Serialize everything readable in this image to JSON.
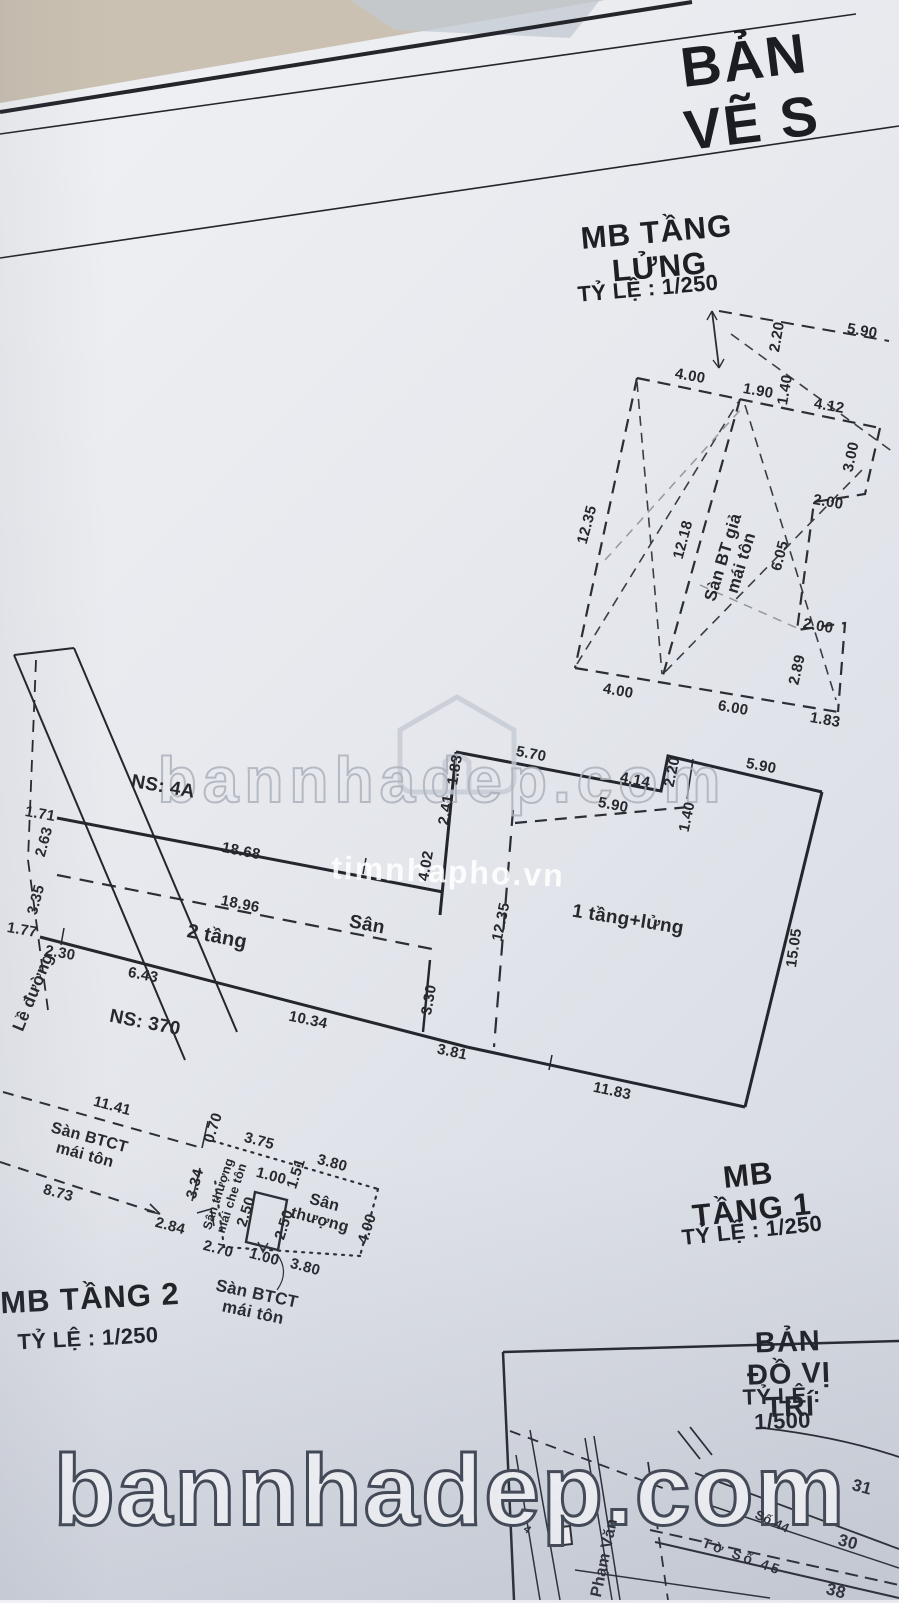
{
  "header": {
    "title": "BẢN VẼ S"
  },
  "watermarks": {
    "big": "bannhadep.com",
    "mid": "bannhadep.com",
    "small": "timnhapho.vn"
  },
  "mezzanine": {
    "title": "MB TẦNG LỬNG",
    "scale": "TỶ LỆ :  1/250",
    "room": "Sàn BT giả\nmái tôn",
    "dims": {
      "d220": "2.20",
      "d590": "5.90",
      "d400": "4.00",
      "d190": "1.90",
      "d140": "1.40",
      "d412": "4.12",
      "d300": "3.00",
      "d200a": "2.00",
      "d1235": "12.35",
      "d1218": "12.18",
      "d605": "6.05",
      "d200b": "2.00",
      "d289": "2.89",
      "d400b": "4.00",
      "d600": "6.00",
      "d183": "1.83"
    }
  },
  "floor1": {
    "title": "MB TẦNG 1",
    "scale": "TỶ LỆ :  1/250",
    "labels": {
      "ns4a": "NS: 4A",
      "ns370": "NS: 370",
      "two_floors": "2 tầng",
      "yard": "Sân",
      "one_floor": "1 tầng+lửng",
      "sidewalk": "Lề đường"
    },
    "dims": {
      "d171": "1.71",
      "d263": "2.63",
      "d1868": "18.68",
      "d335": "3.35",
      "d177": "1.77",
      "d230": "2.30",
      "d1896": "18.96",
      "d643": "6.43",
      "d1034": "10.34",
      "d330": "3.30",
      "d381": "3.81",
      "d402": "4.02",
      "d241": "2.41",
      "d183": "1.83",
      "d1235": "12.35",
      "d570": "5.70",
      "d414": "4.14",
      "d220": "2.20",
      "d590a": "5.90",
      "d140": "1.40",
      "d590b": "5.90",
      "d1505": "15.05",
      "d1183": "11.83"
    }
  },
  "floor2": {
    "title": "MB TẦNG 2",
    "scale": "TỶ LỆ :  1/250",
    "labels": {
      "roof_a": "Sàn BTCT\nmái tôn",
      "terrace_edge": "Sân thượng\nmái che tôn",
      "terrace": "Sân\nthượng",
      "roof_b": "Sàn BTCT\nmái tôn"
    },
    "dims": {
      "d1141": "11.41",
      "d070": "0.70",
      "d873": "8.73",
      "d334": "3.34",
      "d284": "2.84",
      "d375": "3.75",
      "d100a": "1.00",
      "d151": "1.51",
      "d380a": "3.80",
      "d250a": "2.50",
      "d250b": "2.50",
      "d400": "4.00",
      "d270": "2.70",
      "d100b": "1.00",
      "d380b": "3.80"
    }
  },
  "map": {
    "title": "BẢN ĐỒ VỊ TRÍ",
    "scale": "TỶ LỆ :  1/500",
    "labels": {
      "p31": "31",
      "p30": "30",
      "p38": "38",
      "p4": "4",
      "so44": "Số 44",
      "to_so45": "Tờ Số 45",
      "street": "Phạm Văn"
    }
  }
}
